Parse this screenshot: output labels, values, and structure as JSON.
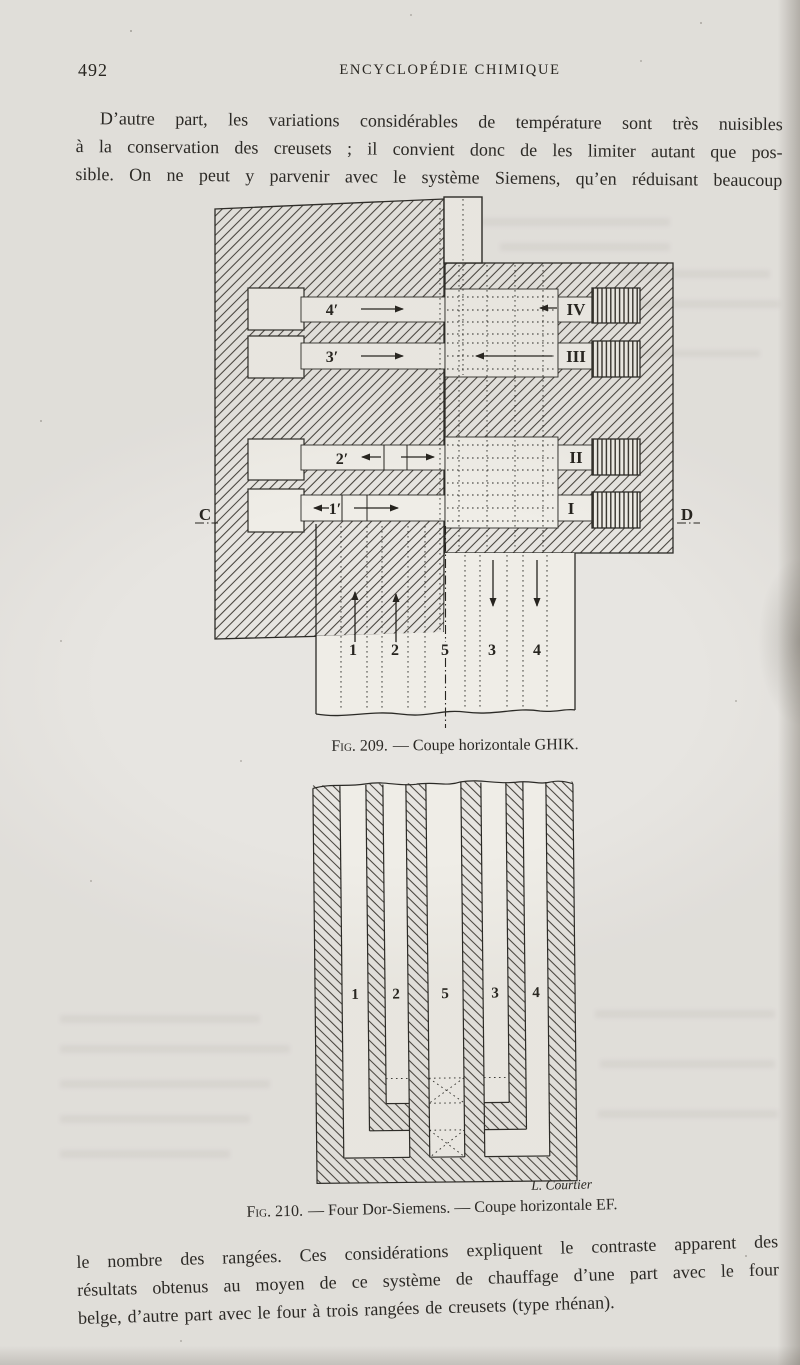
{
  "page": {
    "header": {
      "page_number": "492",
      "title": "ENCYCLOPÉDIE CHIMIQUE"
    },
    "paragraph_top": {
      "lines": [
        "D’autre part, les variations considérables de température sont très nuisibles",
        "à la conservation des creusets ; il convient donc de les limiter autant que pos-",
        "sible. On ne peut y parvenir avec le système Siemens, qu’en réduisant beaucoup"
      ]
    },
    "paragraph_bottom": {
      "lines": [
        "le nombre des rangées. Ces considérations expliquent le contraste apparent des",
        "résultats obtenus au moyen de ce système de chauffage d’une part avec le four",
        "belge, d’autre part avec le four à trois rangées de creusets (type rhénan)."
      ]
    }
  },
  "figure209": {
    "caption": {
      "label": "Fig. 209.",
      "text": "— Coupe horizontale GHIK."
    },
    "labels": {
      "channel_4": "4′",
      "channel_3": "3′",
      "channel_2": "2′",
      "channel_1": "1′",
      "regenerator_4": "IV",
      "regenerator_3": "III",
      "regenerator_2": "II",
      "regenerator_1": "I",
      "section_left": "C",
      "section_right": "D",
      "flues": [
        "1",
        "2",
        "5",
        "3",
        "4"
      ]
    }
  },
  "figure210": {
    "caption": {
      "label": "Fig. 210.",
      "text": "— Four Dor-Siemens. — Coupe horizontale EF."
    },
    "engraver_signature": "L. Courtier",
    "labels": {
      "flues": [
        "1",
        "2",
        "5",
        "3",
        "4"
      ]
    }
  },
  "colors": {
    "paper": "#e7e5e1",
    "figure_white": "#efede7",
    "ink": "#26241f"
  }
}
